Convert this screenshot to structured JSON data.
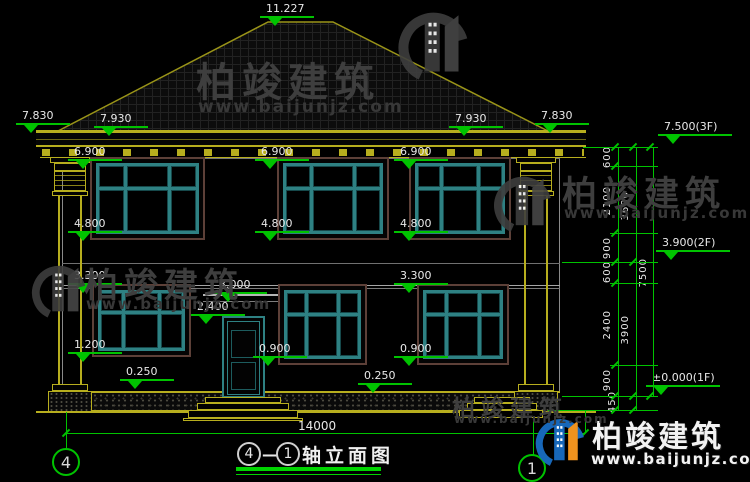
{
  "brand": {
    "name": "柏竣建筑",
    "url": "www.baijunjz.com"
  },
  "title_bar": {
    "axis_from": "4",
    "dash": "—",
    "axis_to": "1",
    "text": "轴立面图"
  },
  "axis_bubbles": {
    "left": "4",
    "right": "1"
  },
  "overall_dim": "14000",
  "floor_levels": {
    "roof_ridge": "11.227",
    "attic": "7.500(3F)",
    "second": "3.900(2F)",
    "first": "±0.000(1F)"
  },
  "elevation_markers": [
    {
      "label": "11.227",
      "x": 266,
      "y": 3,
      "r": false
    },
    {
      "label": "7.830",
      "x": 22,
      "y": 110,
      "r": false
    },
    {
      "label": "7.930",
      "x": 100,
      "y": 113,
      "r": false
    },
    {
      "label": "7.930",
      "x": 455,
      "y": 113,
      "r": false
    },
    {
      "label": "7.830",
      "x": 541,
      "y": 110,
      "r": false
    },
    {
      "label": "6.900",
      "x": 74,
      "y": 146,
      "r": false
    },
    {
      "label": "6.900",
      "x": 261,
      "y": 146,
      "r": false
    },
    {
      "label": "6.900",
      "x": 400,
      "y": 146,
      "r": false
    },
    {
      "label": "4.800",
      "x": 74,
      "y": 218,
      "r": false
    },
    {
      "label": "4.800",
      "x": 261,
      "y": 218,
      "r": false
    },
    {
      "label": "4.800",
      "x": 400,
      "y": 218,
      "r": false
    },
    {
      "label": "3.300",
      "x": 74,
      "y": 270,
      "r": false
    },
    {
      "label": "3.300",
      "x": 400,
      "y": 270,
      "r": false
    },
    {
      "label": "3.000",
      "x": 219,
      "y": 279,
      "r": false
    },
    {
      "label": "2.400",
      "x": 197,
      "y": 301,
      "r": false
    },
    {
      "label": "1.200",
      "x": 74,
      "y": 339,
      "r": false
    },
    {
      "label": "0.900",
      "x": 259,
      "y": 343,
      "r": false
    },
    {
      "label": "0.900",
      "x": 400,
      "y": 343,
      "r": false
    },
    {
      "label": "0.250",
      "x": 126,
      "y": 366,
      "r": false
    },
    {
      "label": "0.250",
      "x": 364,
      "y": 370,
      "r": false
    },
    {
      "label": "7.500(3F)",
      "x": 664,
      "y": 121,
      "r": true
    },
    {
      "label": "3.900(2F)",
      "x": 662,
      "y": 237,
      "r": true
    },
    {
      "label": "±0.000(1F)",
      "x": 652,
      "y": 372,
      "r": true
    }
  ],
  "vertical_dims": [
    {
      "label": "600",
      "x": 602,
      "y": 146
    },
    {
      "label": "2100",
      "x": 602,
      "y": 186
    },
    {
      "label": "900",
      "x": 602,
      "y": 237
    },
    {
      "label": "600",
      "x": 602,
      "y": 261
    },
    {
      "label": "2400",
      "x": 602,
      "y": 310
    },
    {
      "label": "900",
      "x": 602,
      "y": 369
    },
    {
      "label": "450",
      "x": 607,
      "y": 391
    },
    {
      "label": "3600",
      "x": 620,
      "y": 191
    },
    {
      "label": "3900",
      "x": 620,
      "y": 315
    },
    {
      "label": "7500",
      "x": 638,
      "y": 258
    }
  ],
  "layout": {
    "windows": [
      {
        "x": 90,
        "y": 157,
        "w": 115,
        "h": 83
      },
      {
        "x": 277,
        "y": 157,
        "w": 112,
        "h": 83
      },
      {
        "x": 409,
        "y": 157,
        "w": 102,
        "h": 83
      },
      {
        "x": 92,
        "y": 284,
        "w": 99,
        "h": 73
      },
      {
        "x": 278,
        "y": 284,
        "w": 89,
        "h": 81
      },
      {
        "x": 417,
        "y": 284,
        "w": 92,
        "h": 81
      }
    ],
    "chain_lines": [
      {
        "x": 618,
        "y": 147,
        "h": 263
      },
      {
        "x": 636,
        "y": 147,
        "h": 263
      },
      {
        "x": 653,
        "y": 147,
        "h": 249
      }
    ],
    "node_ys": [
      147,
      166,
      233,
      262,
      283,
      365,
      396,
      410
    ],
    "tick_cols": [
      {
        "x": 614,
        "ys": [
          147,
          166,
          233,
          262,
          283,
          365,
          396,
          410
        ]
      },
      {
        "x": 632,
        "ys": [
          147,
          262,
          396,
          410
        ]
      },
      {
        "x": 649,
        "ys": [
          147,
          396
        ]
      }
    ],
    "ext_lines": [
      {
        "x": 583,
        "y": 147,
        "w": 75
      },
      {
        "x": 562,
        "y": 262,
        "w": 96
      },
      {
        "x": 562,
        "y": 396,
        "w": 96
      },
      {
        "x": 548,
        "y": 410,
        "w": 110
      }
    ],
    "door_steps": [
      {
        "x": 205,
        "y": 397,
        "w": 76,
        "h": 6
      },
      {
        "x": 197,
        "y": 403,
        "w": 92,
        "h": 7
      },
      {
        "x": 188,
        "y": 410,
        "w": 110,
        "h": 8
      },
      {
        "x": 183,
        "y": 418,
        "w": 120,
        "h": 3
      }
    ],
    "side_steps": [
      {
        "x": 474,
        "y": 397,
        "w": 56,
        "h": 6
      },
      {
        "x": 467,
        "y": 403,
        "w": 70,
        "h": 7
      },
      {
        "x": 459,
        "y": 410,
        "w": 84,
        "h": 8
      }
    ],
    "watermarks": [
      {
        "tx": 196,
        "ty": 50,
        "fs": 40,
        "ux": 198,
        "uy": 97,
        "ufs": 17,
        "icon": {
          "x": 396,
          "y": 0,
          "s": 80
        }
      },
      {
        "tx": 84,
        "ty": 258,
        "fs": 34,
        "ux": 86,
        "uy": 295,
        "ufs": 15,
        "icon": {
          "x": 30,
          "y": 256,
          "s": 62
        }
      },
      {
        "tx": 562,
        "ty": 166,
        "fs": 35,
        "ux": 564,
        "uy": 204,
        "ufs": 15,
        "icon": {
          "x": 492,
          "y": 166,
          "s": 66
        }
      },
      {
        "tx": 452,
        "ty": 389,
        "fs": 23,
        "ux": 454,
        "uy": 412,
        "ufs": 12,
        "icon": null
      }
    ]
  }
}
